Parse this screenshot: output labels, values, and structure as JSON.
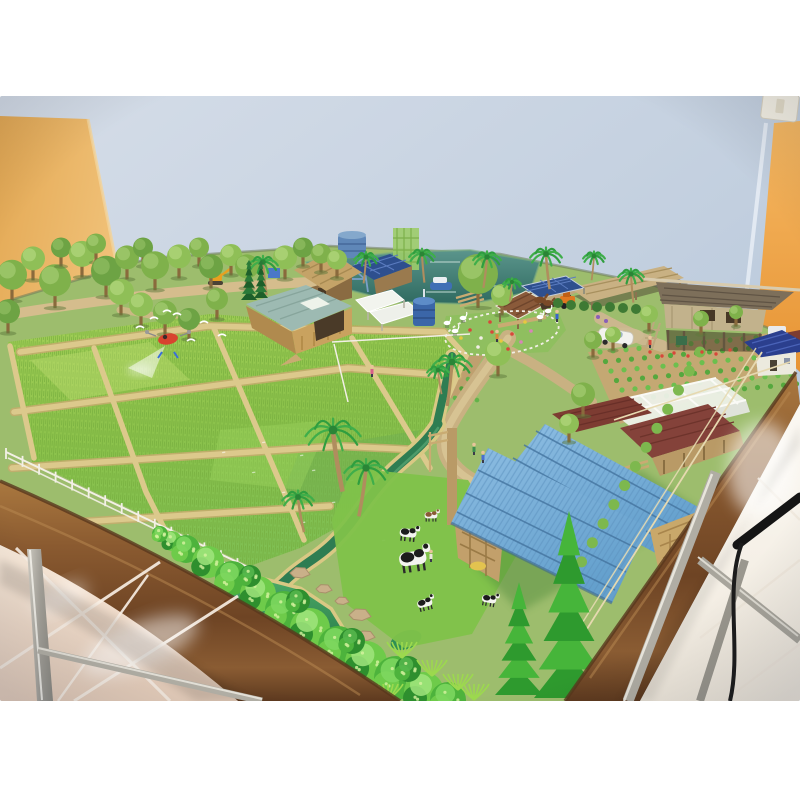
{
  "scene": {
    "description": "Photograph of a miniature smart-farm diorama model on a wooden-framed table with stainless steel legs, in a room with a pale blue back wall, a tan panel on the left, an orange wall on the right and glossy beige floor tiles",
    "room": {
      "wall_back": "pale blue",
      "wall_left_panel": "tan board",
      "wall_right": "orange",
      "light_switch": "white plate, top right",
      "floor": "glossy beige tiles, diagonal grout",
      "cable": "black power cable over right table edge"
    },
    "table": {
      "frame": "dark stained wood",
      "legs": "stainless steel"
    }
  },
  "palette": {
    "wall_blue": "#bfcdde",
    "wall_tan": "#e9b563",
    "wall_orange": "#efa64b",
    "floor_left": "#eed9c8",
    "floor_right": "#f6f1e9",
    "wood_frame": "#7a4e2a",
    "steel": "#b5b2a8",
    "cable": "#151515",
    "paddy_green": "#8cc24b",
    "dike_tan": "#d8c488",
    "stream_water": "#2e7d52",
    "pond_water": "#3f9c5e",
    "back_pond": "#47857b",
    "roof_blue": "#7cb3dc",
    "roof_teal": "#9dbab2",
    "roof_maroon": "#7d3c32",
    "roof_thai": "#7d6f5a",
    "roof_navy": "#2b3f8e",
    "greenhouse": "#edf0e8",
    "solar_panel": "#2e4f8e",
    "tree_green": "#7fb14b",
    "conifer_green": "#2e9a2e",
    "drone_red": "#d8442f",
    "cow_white": "#f4f4f0",
    "cow_black": "#1c1c1c"
  },
  "model": {
    "back_trees": [
      [
        12,
        283,
        15,
        0
      ],
      [
        33,
        265,
        12,
        1
      ],
      [
        55,
        289,
        16,
        0
      ],
      [
        61,
        253,
        10,
        2
      ],
      [
        82,
        261,
        13,
        1
      ],
      [
        96,
        249,
        10,
        0
      ],
      [
        106,
        279,
        15,
        2
      ],
      [
        127,
        264,
        12,
        0
      ],
      [
        121,
        299,
        13,
        1
      ],
      [
        143,
        253,
        10,
        2
      ],
      [
        155,
        273,
        14,
        0
      ],
      [
        141,
        311,
        12,
        1
      ],
      [
        165,
        319,
        12,
        0
      ],
      [
        189,
        325,
        11,
        2
      ],
      [
        179,
        263,
        12,
        1
      ],
      [
        199,
        253,
        10,
        0
      ],
      [
        211,
        273,
        12,
        2
      ],
      [
        217,
        305,
        11,
        0
      ],
      [
        231,
        261,
        11,
        1
      ],
      [
        247,
        273,
        12,
        0
      ],
      [
        285,
        264,
        12,
        1
      ],
      [
        303,
        253,
        10,
        2
      ],
      [
        321,
        259,
        10,
        0
      ],
      [
        337,
        265,
        10,
        1
      ],
      [
        8,
        318,
        12,
        2
      ],
      [
        478,
        285,
        20,
        0
      ],
      [
        502,
        301,
        11,
        1
      ],
      [
        593,
        345,
        9,
        0
      ],
      [
        613,
        339,
        8,
        1
      ],
      [
        583,
        401,
        12,
        0
      ],
      [
        569,
        429,
        10,
        1
      ],
      [
        701,
        323,
        8,
        0
      ],
      [
        649,
        319,
        9,
        1
      ],
      [
        736,
        316,
        7,
        0
      ],
      [
        498,
        360,
        13,
        1
      ]
    ],
    "hedges": [
      [
        558,
        303
      ],
      [
        571,
        305
      ],
      [
        584,
        306
      ],
      [
        597,
        307
      ],
      [
        610,
        307
      ],
      [
        623,
        308
      ],
      [
        636,
        309
      ]
    ],
    "palms": [
      [
        263,
        262,
        15,
        -3
      ],
      [
        366,
        257,
        12,
        2
      ],
      [
        422,
        254,
        13,
        -2
      ],
      [
        487,
        257,
        14,
        3
      ],
      [
        546,
        254,
        16,
        -3
      ],
      [
        512,
        282,
        9,
        2
      ],
      [
        631,
        274,
        13,
        -2
      ],
      [
        594,
        256,
        11,
        2
      ],
      [
        333,
        430,
        28,
        -8
      ],
      [
        366,
        468,
        22,
        6
      ],
      [
        298,
        497,
        16,
        -5
      ],
      [
        452,
        362,
        20,
        4
      ],
      [
        438,
        370,
        11,
        -3
      ]
    ],
    "conifers": [
      [
        519,
        695,
        48,
        112,
        0
      ],
      [
        569,
        698,
        70,
        186,
        0
      ],
      [
        249,
        300,
        16,
        40,
        1
      ],
      [
        261,
        298,
        14,
        38,
        1
      ]
    ],
    "cows": [
      [
        413,
        560,
        1.7,
        -8,
        0
      ],
      [
        408,
        534,
        1.05,
        6,
        0
      ],
      [
        431,
        516,
        0.8,
        0,
        1
      ],
      [
        425,
        604,
        0.95,
        -14,
        0
      ],
      [
        489,
        600,
        0.9,
        10,
        0
      ]
    ],
    "horse": [
      540,
      300
    ],
    "storks": [
      [
        447,
        323
      ],
      [
        455,
        331
      ],
      [
        540,
        317
      ],
      [
        548,
        311
      ],
      [
        463,
        318
      ]
    ],
    "birds": [
      [
        140,
        328
      ],
      [
        154,
        319
      ],
      [
        177,
        315
      ],
      [
        204,
        323
      ],
      [
        222,
        336
      ],
      [
        191,
        341
      ],
      [
        167,
        312
      ]
    ],
    "figures": [
      [
        474,
        449,
        "#3f8f4f"
      ],
      [
        483,
        457,
        "#4a6fd0"
      ],
      [
        431,
        556,
        "#e8e6da"
      ],
      [
        372,
        371,
        "#d85f8a"
      ],
      [
        557,
        316,
        "#3a66c8"
      ],
      [
        650,
        342,
        "#d84a3a"
      ],
      [
        497,
        336,
        "#d8883a"
      ]
    ],
    "front_bushes": [
      [
        172,
        541,
        10,
        1
      ],
      [
        186,
        549,
        14,
        0
      ],
      [
        208,
        562,
        16,
        1
      ],
      [
        232,
        578,
        17,
        0
      ],
      [
        258,
        594,
        18,
        1
      ],
      [
        284,
        610,
        19,
        0
      ],
      [
        310,
        628,
        20,
        1
      ],
      [
        338,
        646,
        20,
        0
      ],
      [
        366,
        662,
        21,
        1
      ],
      [
        396,
        678,
        22,
        0
      ],
      [
        424,
        692,
        20,
        1
      ],
      [
        448,
        700,
        18,
        0
      ],
      [
        250,
        576,
        11,
        2
      ],
      [
        298,
        601,
        12,
        2
      ],
      [
        352,
        641,
        13,
        2
      ],
      [
        408,
        669,
        13,
        2
      ],
      [
        160,
        534,
        8,
        0
      ]
    ],
    "ferns": [
      [
        402,
        658
      ],
      [
        432,
        676
      ],
      [
        458,
        690
      ],
      [
        474,
        700
      ],
      [
        388,
        700
      ]
    ],
    "rocks": [
      [
        300,
        573,
        10
      ],
      [
        324,
        589,
        8
      ],
      [
        360,
        615,
        11
      ],
      [
        342,
        601,
        7
      ],
      [
        366,
        636,
        9
      ]
    ],
    "paddy_glints": [
      [
        312,
        470
      ],
      [
        282,
        492
      ],
      [
        332,
        502
      ],
      [
        252,
        472
      ],
      [
        352,
        522
      ],
      [
        302,
        522
      ],
      [
        382,
        540
      ],
      [
        262,
        442
      ],
      [
        222,
        452
      ],
      [
        332,
        442
      ],
      [
        300,
        455
      ],
      [
        350,
        480
      ]
    ],
    "flowers_center": [
      [
        470,
        330,
        "#d8473a"
      ],
      [
        481,
        338,
        "#f2efe6"
      ],
      [
        492,
        332,
        "#d8473a"
      ],
      [
        501,
        341,
        "#e6c93f"
      ],
      [
        512,
        334,
        "#d8473a"
      ],
      [
        521,
        342,
        "#d884b8"
      ],
      [
        478,
        347,
        "#f2efe6"
      ],
      [
        508,
        349,
        "#d8473a"
      ],
      [
        531,
        331,
        "#d884b8"
      ],
      [
        461,
        338,
        "#e6c93f"
      ],
      [
        490,
        322,
        "#d8473a"
      ],
      [
        525,
        322,
        "#e6c93f"
      ]
    ],
    "flowers_fence": [
      [
        650,
        352
      ],
      [
        662,
        356
      ],
      [
        674,
        353
      ],
      [
        688,
        356
      ],
      [
        702,
        352
      ],
      [
        716,
        354
      ],
      [
        730,
        350
      ]
    ],
    "flowers_purple": [
      [
        598,
        317
      ],
      [
        606,
        321
      ]
    ],
    "garden_mid": {
      "rows": 5,
      "cols": 12
    },
    "garden_right": {
      "rows": 6,
      "cols": 14
    },
    "edge_tufts": 14,
    "drone": {
      "x": 168,
      "y": 339
    }
  }
}
